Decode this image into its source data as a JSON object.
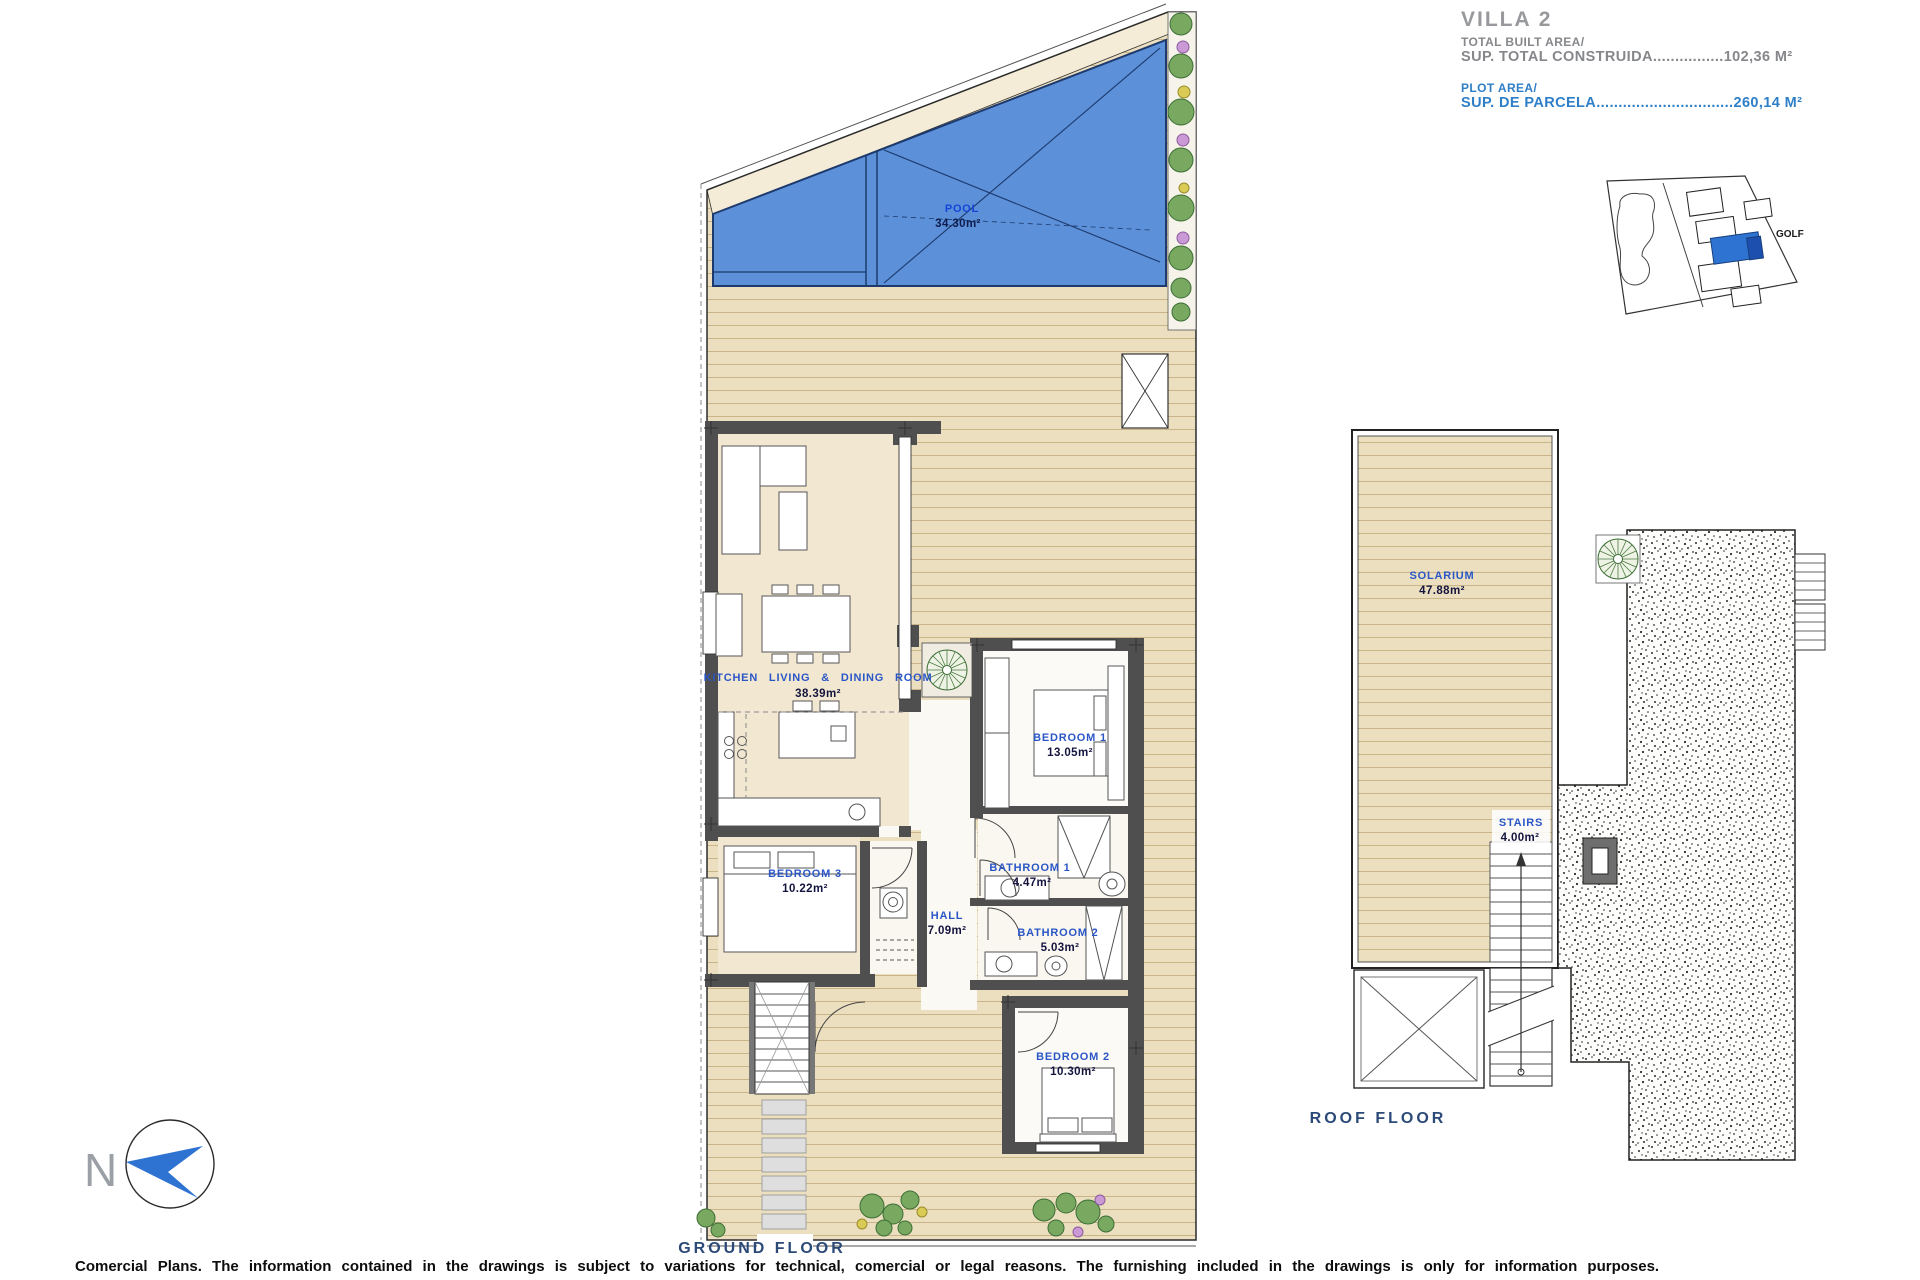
{
  "title_block": {
    "villa": "VILLA 2",
    "built_area_label_en": "TOTAL BUILT AREA/",
    "built_area_label_es": "SUP. TOTAL CONSTRUIDA",
    "built_area_leader": "................",
    "built_area_value": "102,36 M²",
    "plot_area_label_en": "PLOT AREA/",
    "plot_area_label_es": "SUP. DE PARCELA",
    "plot_area_leader": "...............................",
    "plot_area_value": "260,14 M²"
  },
  "site_plan": {
    "golf_label": "GOLF"
  },
  "ground_floor": {
    "caption": "GROUND  FLOOR",
    "rooms": [
      {
        "name": "POOL",
        "area": "34.30m²"
      },
      {
        "name": "KITCHEN  LIVING  &  DINING   ROOM",
        "area": "38.39m²"
      },
      {
        "name": "BEDROOM  1",
        "area": "13.05m²"
      },
      {
        "name": "BATHROOM  1",
        "area": "4.47m²"
      },
      {
        "name": "HALL",
        "area": "7.09m²"
      },
      {
        "name": "BATHROOM  2",
        "area": "5.03m²"
      },
      {
        "name": "BEDROOM  3",
        "area": "10.22m²"
      },
      {
        "name": "BEDROOM  2",
        "area": "10.30m²"
      }
    ]
  },
  "roof_floor": {
    "caption": "ROOF  FLOOR",
    "rooms": [
      {
        "name": "SOLARIUM",
        "area": "47.88m²"
      },
      {
        "name": "STAIRS",
        "area": "4.00m²"
      }
    ]
  },
  "compass": {
    "north_label": "N"
  },
  "footer": {
    "disclaimer": "Comercial Plans. The information contained in the drawings is subject to variations for technical, comercial or legal reasons. The furnishing included in the drawings is only for information purposes."
  },
  "colors": {
    "pool_blue": "#5c90d8",
    "deck_beige": "#ebdfc0",
    "deck_line": "#c9b588",
    "wall_gray": "#4f4f4f",
    "room_label_blue": "#2a56c6",
    "accent_blue": "#2e7fc8",
    "highlight_unit_blue": "#2e72d2",
    "caption_navy": "#2c4a78"
  }
}
